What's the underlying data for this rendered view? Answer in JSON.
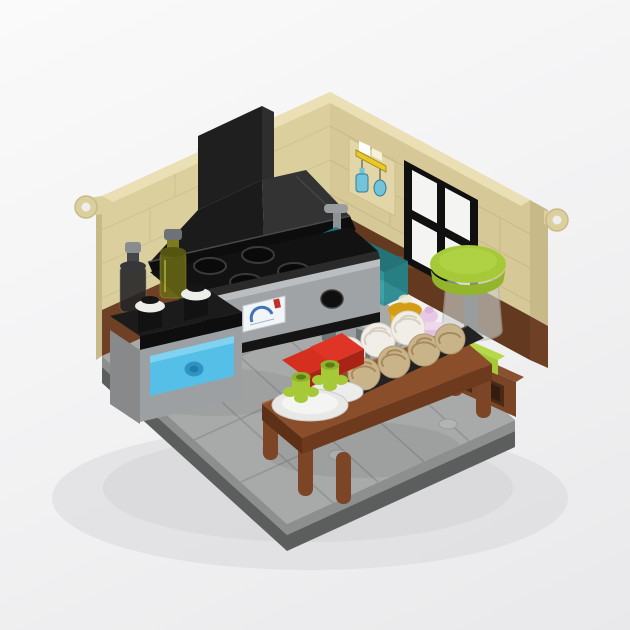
{
  "image": {
    "alt": "LEGO kitchen interior model on a white background",
    "style": "isometric brick-built room render"
  },
  "palette": {
    "bg_top": "#fafafa",
    "bg_bottom": "#e9e9eb",
    "shadow": "#d9d9dc",
    "wall_tan": "#dbcf9e",
    "wall_tan_right": "#d6c997",
    "wall_tan_top": "#eadfb5",
    "wall_tan_edge": "#c8ba88",
    "brick_seam": "#cdc08e",
    "brick_seam_r": "#c6b884",
    "dado_brown": "#6e4025",
    "dado_brown_dark": "#63391f",
    "floor": "#a8aaa9",
    "floor_seam": "#8f9290",
    "floor_tile_light": "#b3b5b4",
    "rim_step": "#8d8f8e",
    "rim_dark": "#5c5e5d",
    "hood_face": "#1b1b1b",
    "hood_side": "#333333",
    "hood_rim": "#0d0d0d",
    "cooktop": "#121212",
    "oven_gray": "#a0a3a5",
    "oven_lip": "#bbbec0",
    "knob_black": "#0f0f0f",
    "sticker_white": "#f2f5f7",
    "sticker_blue": "#3f74b5",
    "sticker_red": "#c03028",
    "azure": "#56bfe7",
    "azure_light": "#7fd2f0",
    "azure_dark": "#2f93c4",
    "teal": "#2f9aa0",
    "teal_dark": "#20767d",
    "gray_part": "#8f9294",
    "gray_light": "#b9bbbc",
    "lime": "#a6ca37",
    "lime_dark": "#8fb32a",
    "lime_bright": "#b5d947",
    "table_top": "#8a4e2b",
    "table_side": "#6e3a1d",
    "table_leg": "#7c4526",
    "bench_brown": "#7a4426",
    "bench_top": "#8a5130",
    "bench_hole": "#4a2a16",
    "red": "#d5301f",
    "red_dark": "#a92317",
    "red_bright": "#de3526",
    "plate_white": "#ececea",
    "swirl_white": "#f1eee8",
    "swirl_white_line": "#d6cfc2",
    "swirl_tan": "#c9b48a",
    "swirl_tan_line": "#a68b5e",
    "jar_yellow": "#f0bc1f",
    "jar_gold": "#d39d15",
    "cup_lavender": "#e2c0e0",
    "cup_lavender_light": "#efd7ee",
    "window_pane": "#f4f4f2",
    "frame_black": "#101010",
    "decal_blue": "#74c3d8",
    "decal_yellow": "#e8c927"
  },
  "scene": {
    "parts": [
      {
        "name": "left-wall",
        "color": "wall_tan"
      },
      {
        "name": "right-wall",
        "color": "wall_tan_right"
      },
      {
        "name": "wainscot",
        "color": "dado_brown"
      },
      {
        "name": "window",
        "color": "frame_black"
      },
      {
        "name": "utensil-decal",
        "color": "decal_blue"
      },
      {
        "name": "range-hood",
        "color": "hood_face"
      },
      {
        "name": "stove-oven",
        "color": "oven_gray"
      },
      {
        "name": "sink",
        "color": "teal"
      },
      {
        "name": "counter-drawer",
        "color": "azure"
      },
      {
        "name": "blender",
        "color": "lime"
      },
      {
        "name": "dining-table",
        "color": "table_top"
      },
      {
        "name": "milkshake-cup",
        "color": "cup_lavender"
      },
      {
        "name": "honey-jar",
        "color": "jar_yellow"
      },
      {
        "name": "pastries",
        "color": "swirl_tan"
      },
      {
        "name": "floor",
        "color": "floor"
      }
    ]
  }
}
